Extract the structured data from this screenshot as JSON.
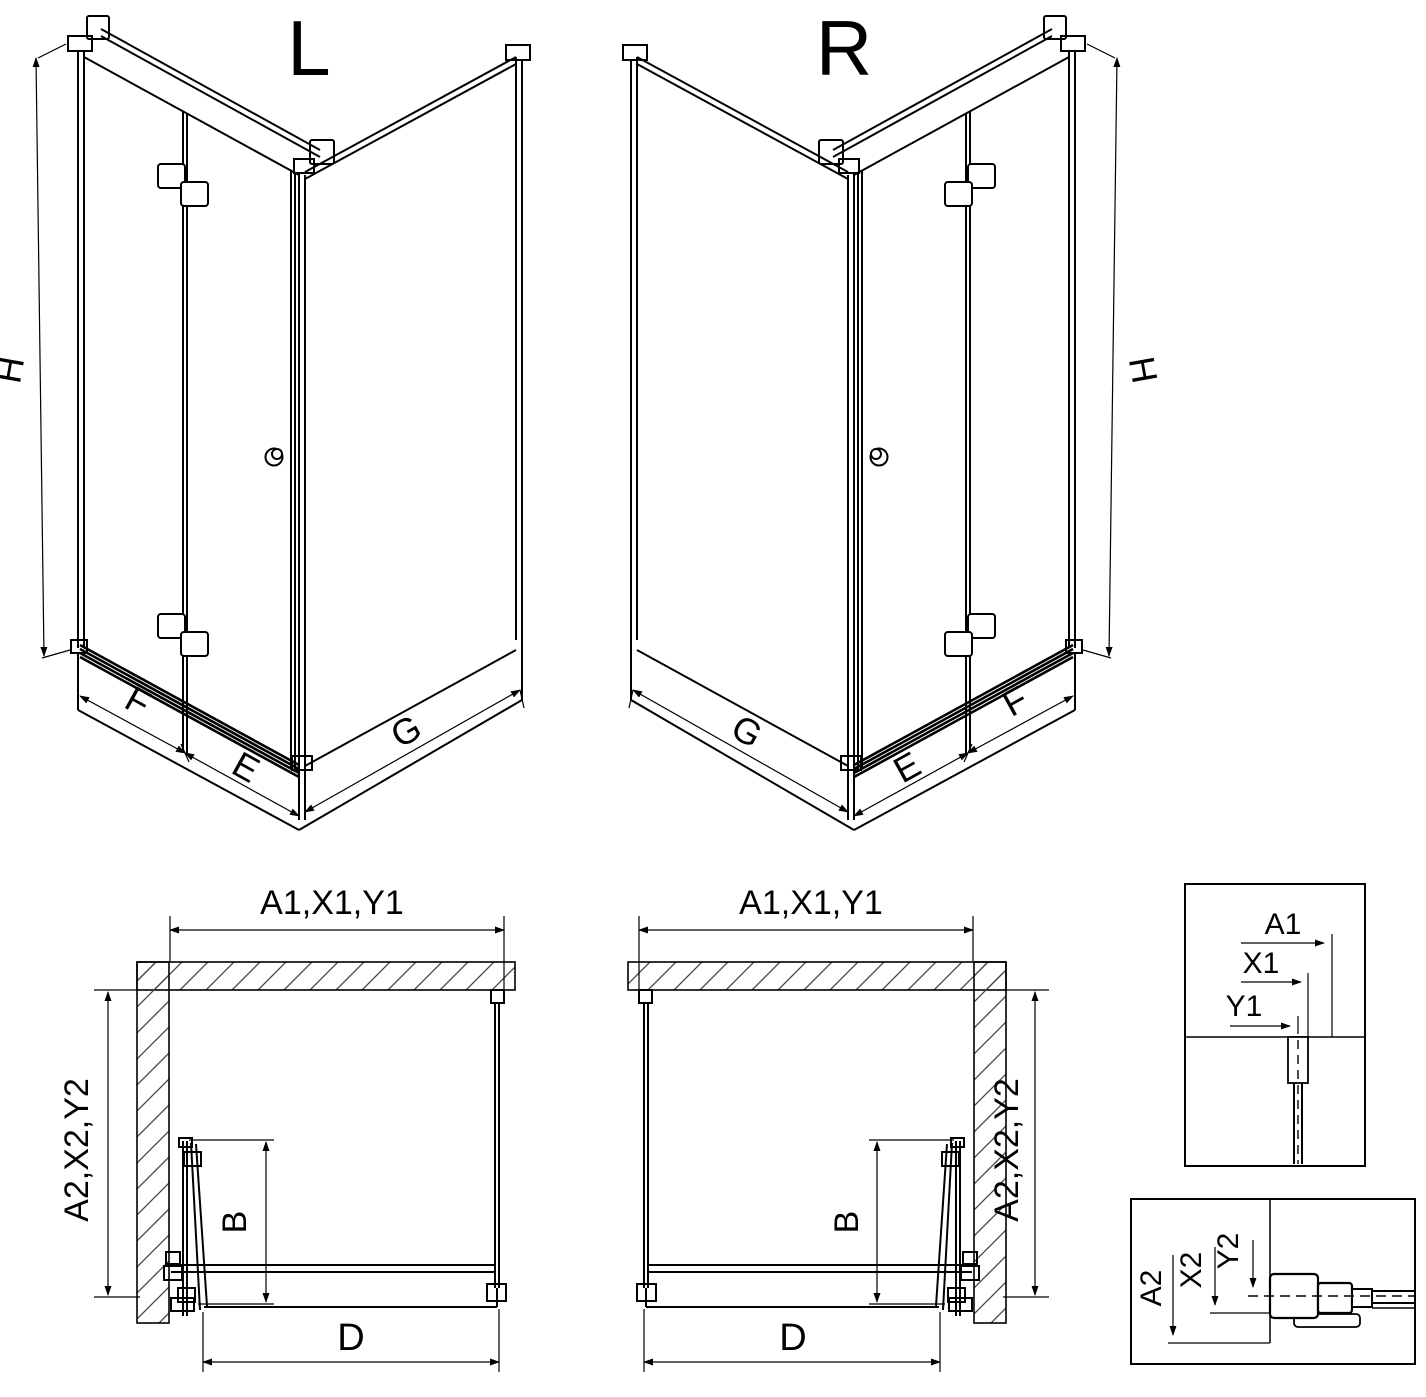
{
  "page": {
    "background": "#ffffff",
    "line_color": "#000000",
    "hatch_color": "#555555"
  },
  "iso_left": {
    "title": "L",
    "height_dim": "H",
    "fixed_panel_dim": "F",
    "door_leaf_dim": "E",
    "side_panel_dim": "G"
  },
  "iso_right": {
    "title": "R",
    "height_dim": "H",
    "fixed_panel_dim": "F",
    "door_leaf_dim": "E",
    "side_panel_dim": "G"
  },
  "plan_left": {
    "width_dim": "A1,X1,Y1",
    "depth_dim": "A2,X2,Y2",
    "fold_depth_dim": "B",
    "opening_dim": "D"
  },
  "plan_right": {
    "width_dim": "A1,X1,Y1",
    "depth_dim": "A2,X2,Y2",
    "fold_depth_dim": "B",
    "opening_dim": "D"
  },
  "detail_width": {
    "labels": [
      "A1",
      "X1",
      "Y1"
    ]
  },
  "detail_depth": {
    "labels": [
      "A2",
      "X2",
      "Y2"
    ]
  }
}
